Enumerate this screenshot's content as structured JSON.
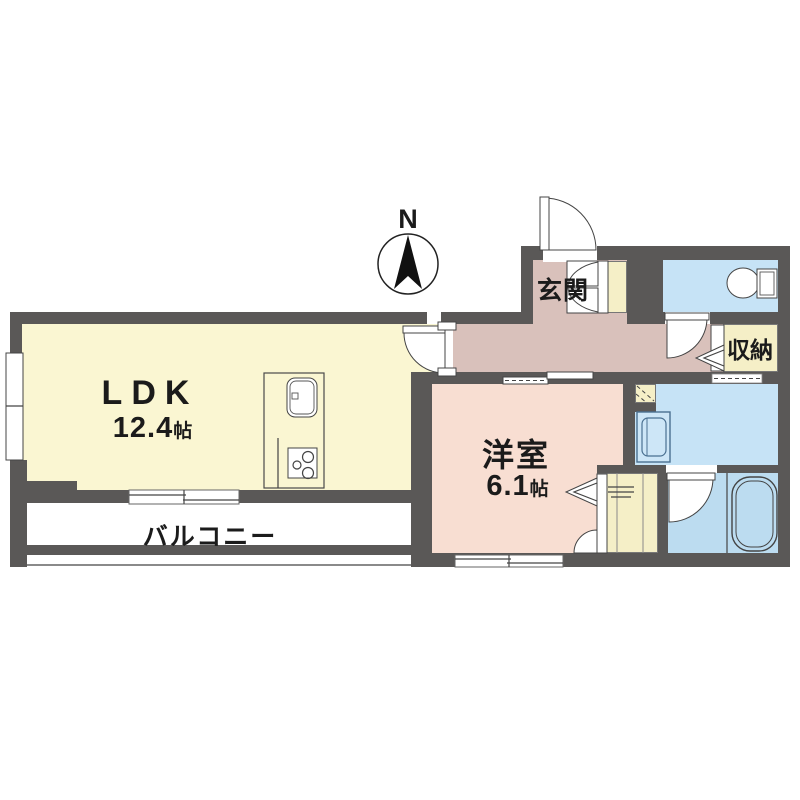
{
  "compass": {
    "label": "N"
  },
  "rooms": {
    "ldk": {
      "label": "LDK",
      "size": "12.4",
      "unit": "帖"
    },
    "western": {
      "label": "洋室",
      "size": "6.1",
      "unit": "帖"
    },
    "entrance": {
      "label": "玄関"
    },
    "storage": {
      "label": "収納"
    },
    "balcony": {
      "label": "バルコニー"
    }
  },
  "icons": [
    "north-arrow-icon",
    "entrance-door-icon",
    "ldk-door-icon",
    "toilet-icon",
    "toilet-door-icon",
    "kitchen-sink-icon",
    "gas-stove-icon",
    "washing-machine-icon",
    "bathtub-icon",
    "bath-door-icon",
    "closet-folding-door-icon",
    "closet-hinged-door-icon",
    "storage-folding-door-icon",
    "sliding-door-icon",
    "sliding-window-icon",
    "window-icon",
    "shoe-cabinet-door-icon",
    "hatch-niche-icon"
  ],
  "colors": {
    "wall": "#5a5857",
    "ldk": "#faf6d2",
    "western": "#f8ded2",
    "hall": "#d9c1bb",
    "water": "#c6e3f6",
    "bath": "#bcdcf0",
    "cream": "#f5efc7",
    "line": "#444444",
    "balcony_line": "#8a8a8a"
  }
}
